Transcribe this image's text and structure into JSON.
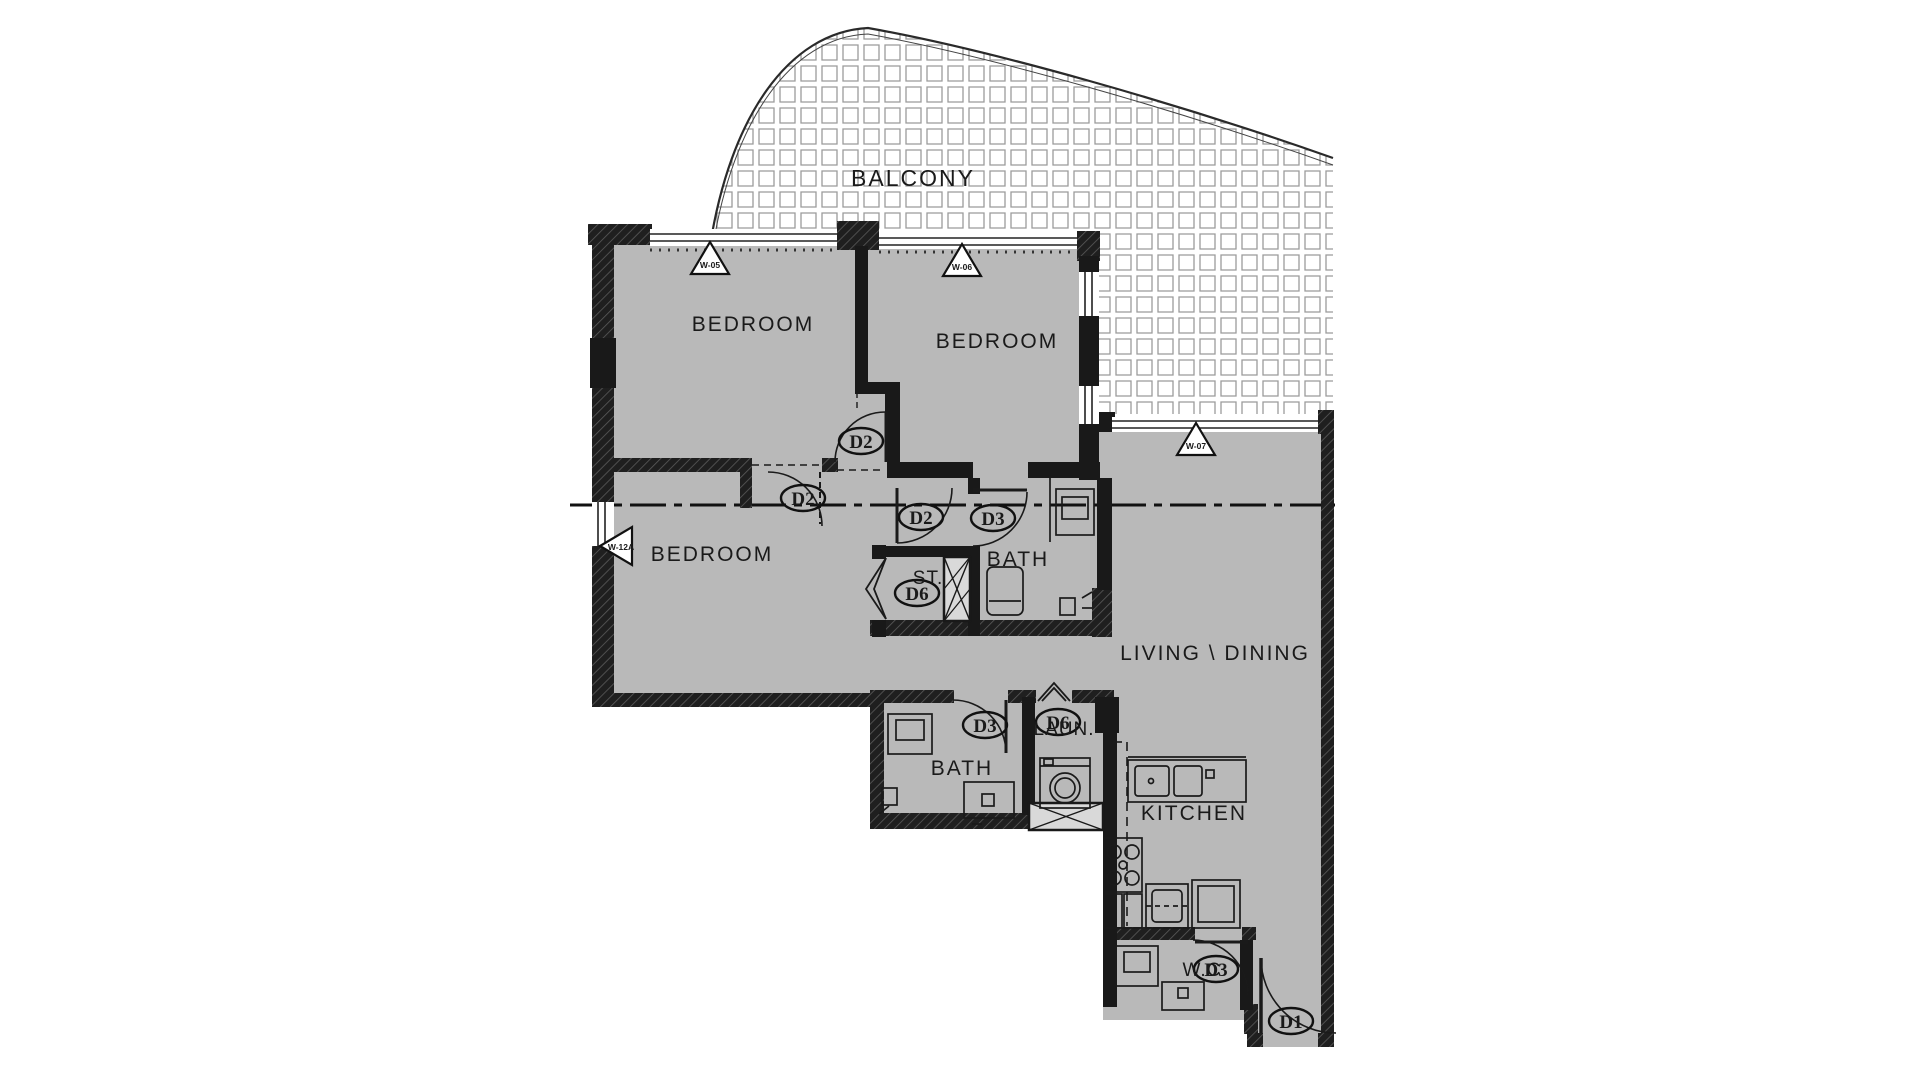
{
  "colors": {
    "floor": "#b9b9b9",
    "wall": "#191919",
    "line": "#1a1a1a",
    "balcony_grid": "#9b9b9b"
  },
  "rooms": {
    "balcony": "BALCONY",
    "bedroom1": "BEDROOM",
    "bedroom2": "BEDROOM",
    "bedroom3": "BEDROOM",
    "bath1": "BATH",
    "bath2": "BATH",
    "storage": "ST.",
    "living": "LIVING \\ DINING",
    "laundry": "LAUN.",
    "kitchen": "KITCHEN",
    "wc": "W.C"
  },
  "doors": {
    "entrance": "D1",
    "bedroom1": "D2",
    "bedroom2": "D2",
    "hall": "D2",
    "bath1": "D3",
    "bath2": "D3",
    "wc": "D3",
    "storage": "D6",
    "laundry": "D6"
  },
  "windows": {
    "w05": "W-05",
    "w06": "W-06",
    "w07": "W-07",
    "w12a": "W-12A"
  }
}
